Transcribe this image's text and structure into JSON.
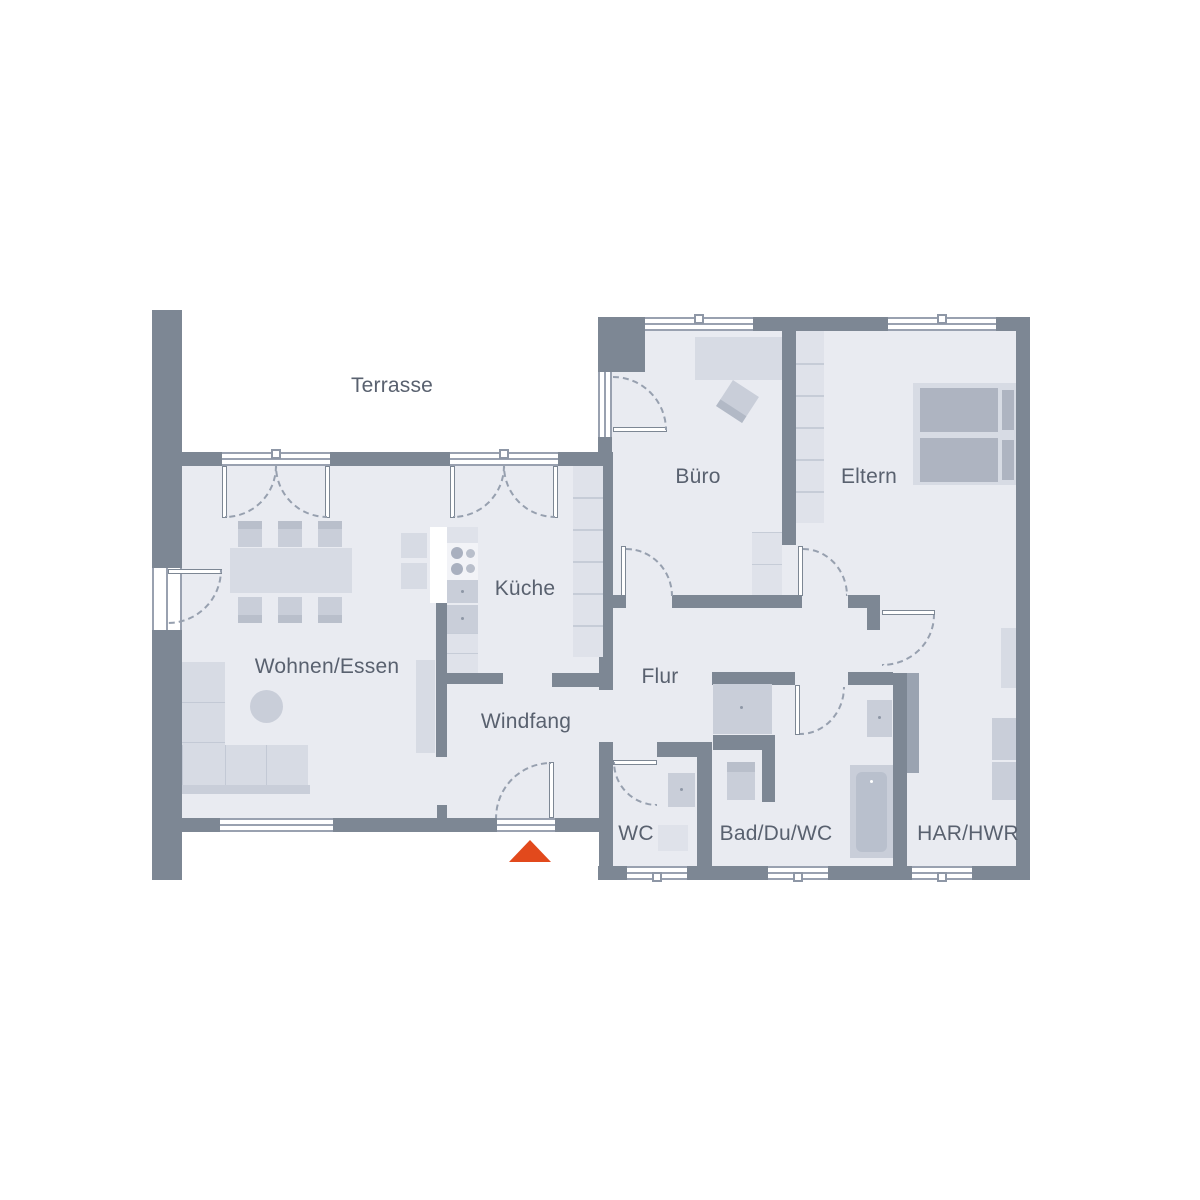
{
  "plan": {
    "type": "residential-floor-plan",
    "rooms": {
      "terrasse": {
        "label": "Terrasse"
      },
      "wohnen_essen": {
        "label": "Wohnen/Essen"
      },
      "kueche": {
        "label": "Küche"
      },
      "windfang": {
        "label": "Windfang"
      },
      "flur": {
        "label": "Flur"
      },
      "buero": {
        "label": "Büro"
      },
      "eltern": {
        "label": "Eltern"
      },
      "wc": {
        "label": "WC"
      },
      "bad": {
        "label": "Bad/Du/WC"
      },
      "har_hwr": {
        "label": "HAR/HWR"
      }
    },
    "colors": {
      "background": "#ffffff",
      "wall": "#7d8794",
      "floor": "#e9ebf1",
      "furniture_light": "#d7dbe4",
      "furniture_mid": "#c9ced9",
      "furniture_dark": "#aeb4c1",
      "door_arc": "#97a0af",
      "label_text": "#59616f",
      "entrance_arrow": "#e2491c"
    },
    "entrance_marker": {
      "symbol": "arrow-up-triangle"
    }
  }
}
